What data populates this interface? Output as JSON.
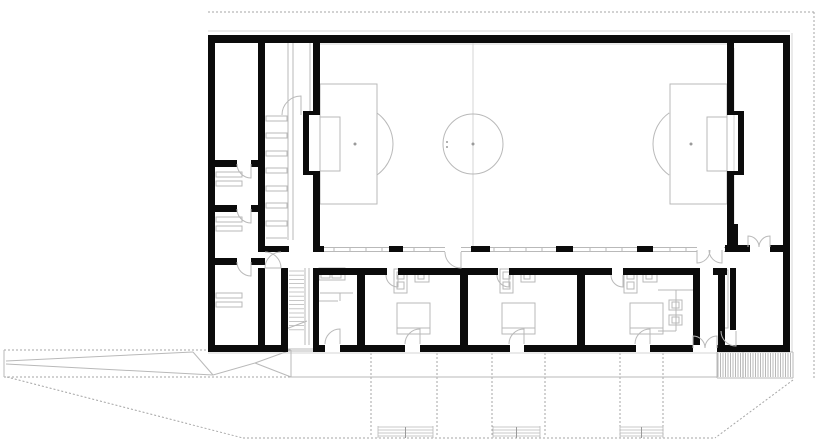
{
  "drawing": {
    "kind": "architectural-floor-plan",
    "canvas": {
      "w": 818,
      "h": 444,
      "bg": "#ffffff"
    },
    "colors": {
      "wall": "#0b0b0b",
      "thin": "#b9b9b9",
      "light": "#d4d4d4",
      "dash": "#a6a6a6",
      "hatch": "#9a9a9a",
      "dot": "#9a9a9a"
    },
    "walls": [
      [
        208,
        35,
        582,
        8
      ],
      [
        208,
        35,
        7,
        313
      ],
      [
        783,
        35,
        7,
        317
      ],
      [
        258,
        43,
        7,
        209
      ],
      [
        258,
        268,
        7,
        77
      ],
      [
        215,
        160,
        22,
        7
      ],
      [
        251,
        160,
        14,
        7
      ],
      [
        215,
        205,
        22,
        7
      ],
      [
        251,
        205,
        14,
        7
      ],
      [
        215,
        258,
        22,
        7
      ],
      [
        251,
        258,
        14,
        7
      ],
      [
        313,
        43,
        7,
        72
      ],
      [
        303,
        111,
        17,
        4
      ],
      [
        303,
        111,
        6,
        64
      ],
      [
        303,
        171,
        17,
        4
      ],
      [
        313,
        171,
        7,
        76
      ],
      [
        727,
        43,
        7,
        72
      ],
      [
        727,
        111,
        17,
        4
      ],
      [
        738,
        111,
        6,
        64
      ],
      [
        727,
        171,
        17,
        4
      ],
      [
        727,
        171,
        7,
        76
      ],
      [
        258,
        246,
        31,
        6
      ],
      [
        313,
        246,
        11,
        6
      ],
      [
        389,
        246,
        14,
        6
      ],
      [
        471,
        246,
        19,
        6
      ],
      [
        556,
        246,
        17,
        6
      ],
      [
        637,
        246,
        16,
        6
      ],
      [
        725,
        245,
        25,
        7
      ],
      [
        770,
        245,
        20,
        7
      ],
      [
        732,
        224,
        6,
        27
      ],
      [
        281,
        268,
        7,
        77
      ],
      [
        313,
        268,
        6,
        77
      ],
      [
        313,
        268,
        74,
        7
      ],
      [
        398,
        268,
        100,
        7
      ],
      [
        509,
        268,
        103,
        7
      ],
      [
        623,
        268,
        77,
        7
      ],
      [
        713,
        268,
        14,
        7
      ],
      [
        357,
        268,
        8,
        77
      ],
      [
        460,
        268,
        8,
        77
      ],
      [
        577,
        268,
        8,
        77
      ],
      [
        693,
        268,
        7,
        77
      ],
      [
        718,
        268,
        7,
        77
      ],
      [
        730,
        268,
        6,
        62
      ],
      [
        208,
        345,
        80,
        7
      ],
      [
        313,
        345,
        12,
        7
      ],
      [
        340,
        345,
        65,
        7
      ],
      [
        420,
        345,
        90,
        7
      ],
      [
        524,
        345,
        112,
        7
      ],
      [
        650,
        345,
        43,
        7
      ],
      [
        717,
        345,
        73,
        7
      ]
    ],
    "outline_rects": [
      [
        320,
        84,
        57,
        120
      ],
      [
        320,
        117,
        20,
        54
      ],
      [
        670,
        84,
        57,
        120
      ],
      [
        707,
        117,
        20,
        54
      ],
      [
        266,
        116,
        21,
        5
      ],
      [
        266,
        133,
        21,
        5
      ],
      [
        266,
        151,
        21,
        5
      ],
      [
        266,
        168,
        21,
        5
      ],
      [
        266,
        186,
        21,
        5
      ],
      [
        266,
        203,
        21,
        5
      ],
      [
        266,
        221,
        21,
        5
      ],
      [
        397,
        303,
        33,
        31
      ],
      [
        502,
        303,
        33,
        31
      ],
      [
        630,
        303,
        33,
        31
      ],
      [
        394,
        269,
        13,
        24
      ],
      [
        397,
        272,
        7,
        7
      ],
      [
        397,
        282,
        7,
        7
      ],
      [
        500,
        269,
        13,
        24
      ],
      [
        503,
        272,
        7,
        7
      ],
      [
        503,
        282,
        7,
        7
      ],
      [
        624,
        269,
        13,
        24
      ],
      [
        627,
        272,
        7,
        7
      ],
      [
        627,
        282,
        7,
        7
      ],
      [
        415,
        271,
        14,
        11
      ],
      [
        418,
        274,
        6,
        5
      ],
      [
        521,
        271,
        14,
        11
      ],
      [
        524,
        274,
        6,
        5
      ],
      [
        643,
        271,
        14,
        11
      ],
      [
        646,
        274,
        6,
        5
      ],
      [
        319,
        268,
        26,
        12
      ],
      [
        321,
        270,
        9,
        8
      ],
      [
        332,
        270,
        9,
        8
      ],
      [
        216,
        172,
        26,
        5
      ],
      [
        216,
        181,
        26,
        5
      ],
      [
        216,
        217,
        26,
        5
      ],
      [
        216,
        226,
        26,
        5
      ],
      [
        216,
        293,
        26,
        5
      ],
      [
        216,
        302,
        26,
        5
      ],
      [
        723,
        270,
        5,
        58
      ],
      [
        669,
        300,
        13,
        10
      ],
      [
        672,
        302,
        7,
        6
      ],
      [
        669,
        315,
        13,
        10
      ],
      [
        672,
        317,
        7,
        6
      ]
    ],
    "lines": [
      [
        288,
        43,
        288,
        240
      ],
      [
        293,
        43,
        293,
        240
      ],
      [
        310,
        43,
        310,
        111
      ],
      [
        305,
        268,
        305,
        345
      ],
      [
        309,
        268,
        309,
        345
      ],
      [
        286,
        329,
        307,
        321
      ],
      [
        266,
        238,
        287,
        238
      ],
      [
        320,
        293,
        353,
        293
      ],
      [
        340,
        293,
        340,
        301
      ],
      [
        318,
        301,
        338,
        301
      ],
      [
        658,
        290,
        693,
        290
      ],
      [
        676,
        290,
        676,
        331
      ],
      [
        658,
        331,
        676,
        331
      ],
      [
        397,
        328,
        430,
        328
      ],
      [
        502,
        328,
        535,
        328
      ],
      [
        630,
        328,
        663,
        328
      ],
      [
        4,
        350,
        4,
        377
      ],
      [
        6,
        361,
        193,
        352
      ],
      [
        6,
        364,
        213,
        375
      ],
      [
        193,
        352,
        213,
        375
      ],
      [
        213,
        375,
        255,
        363
      ],
      [
        255,
        363,
        291,
        350
      ],
      [
        255,
        363,
        291,
        377
      ],
      [
        291,
        350,
        291,
        377
      ],
      [
        288,
        349,
        313,
        349
      ],
      [
        288,
        351,
        313,
        351
      ],
      [
        717,
        352,
        793,
        352
      ],
      [
        717,
        378,
        793,
        378
      ],
      [
        717,
        352,
        717,
        378
      ],
      [
        793,
        352,
        793,
        378
      ],
      [
        743,
        352,
        743,
        378
      ],
      [
        290,
        377,
        717,
        377
      ]
    ],
    "light_lines": [
      [
        208,
        31,
        790,
        31
      ],
      [
        792,
        33,
        792,
        352
      ],
      [
        208,
        353,
        717,
        353
      ],
      [
        320,
        44,
        727,
        44
      ],
      [
        734,
        48,
        734,
        244
      ],
      [
        473,
        43,
        473,
        246
      ]
    ],
    "dashed_lines": [
      [
        208,
        12,
        814,
        12
      ],
      [
        814,
        12,
        814,
        380
      ],
      [
        4,
        350,
        290,
        350
      ],
      [
        4,
        377,
        290,
        377
      ],
      [
        7,
        377,
        243,
        438
      ],
      [
        243,
        438,
        715,
        438
      ],
      [
        793,
        380,
        715,
        438
      ],
      [
        371,
        353,
        371,
        437
      ],
      [
        437,
        353,
        437,
        437
      ],
      [
        492,
        353,
        492,
        437
      ],
      [
        545,
        353,
        545,
        437
      ],
      [
        620,
        353,
        620,
        437
      ],
      [
        663,
        353,
        663,
        437
      ]
    ],
    "window_band": {
      "y1": 247.5,
      "y2": 251.5,
      "segments": [
        [
          313,
          445
        ],
        [
          461,
          697
        ],
        [
          724,
          748
        ],
        [
          770,
          790
        ]
      ],
      "tick_from": 318,
      "tick_to": 786,
      "tick_step": 16,
      "tick_skip": [
        [
          385,
          405
        ],
        [
          443,
          463
        ],
        [
          469,
          492
        ],
        [
          554,
          575
        ],
        [
          635,
          655
        ],
        [
          695,
          726
        ],
        [
          746,
          772
        ]
      ]
    },
    "stair_lower": {
      "x1": 289,
      "x2": 304,
      "y0": 271,
      "step": 4.2,
      "count": 15
    },
    "hatch_blocks": [
      {
        "x": 718,
        "y": 353,
        "w": 74,
        "h": 24,
        "step": 2.5
      }
    ],
    "step_strips": {
      "y_lines": [
        427,
        430,
        433,
        436
      ],
      "y_top": 426,
      "y_bot": 438,
      "ranges": [
        [
          378,
          433
        ],
        [
          493,
          540
        ],
        [
          620,
          663
        ]
      ]
    },
    "pitch": {
      "circle": [
        473,
        144,
        30
      ],
      "arcs": [
        [
          355,
          144,
          38,
          -55,
          55
        ],
        [
          691,
          144,
          38,
          125,
          235
        ]
      ],
      "dots": [
        [
          473,
          144,
          1.5
        ],
        [
          355,
          144,
          1.5
        ],
        [
          691,
          144,
          1.5
        ],
        [
          447,
          142,
          1
        ],
        [
          447,
          147,
          1
        ]
      ]
    },
    "doors": [
      [
        251,
        164,
        14,
        180,
        90
      ],
      [
        251,
        209,
        14,
        180,
        90
      ],
      [
        251,
        262,
        14,
        180,
        90
      ],
      [
        301,
        115,
        19,
        180,
        270
      ],
      [
        265,
        268,
        16,
        270,
        360
      ],
      [
        281,
        268,
        16,
        270,
        180
      ],
      [
        461,
        252,
        16,
        180,
        90
      ],
      [
        398,
        275,
        12,
        180,
        90
      ],
      [
        509,
        275,
        12,
        180,
        90
      ],
      [
        623,
        275,
        12,
        180,
        90
      ],
      [
        340,
        344,
        15,
        180,
        270
      ],
      [
        420,
        344,
        15,
        180,
        270
      ],
      [
        524,
        344,
        15,
        180,
        270
      ],
      [
        650,
        344,
        15,
        180,
        270
      ],
      [
        697,
        250,
        13,
        0,
        90
      ],
      [
        722,
        250,
        13,
        180,
        90
      ],
      [
        748,
        247,
        11,
        0,
        270
      ],
      [
        770,
        247,
        11,
        180,
        270
      ],
      [
        693,
        348,
        12,
        0,
        270
      ],
      [
        717,
        348,
        12,
        180,
        270
      ],
      [
        736,
        331,
        15,
        180,
        90
      ]
    ]
  }
}
